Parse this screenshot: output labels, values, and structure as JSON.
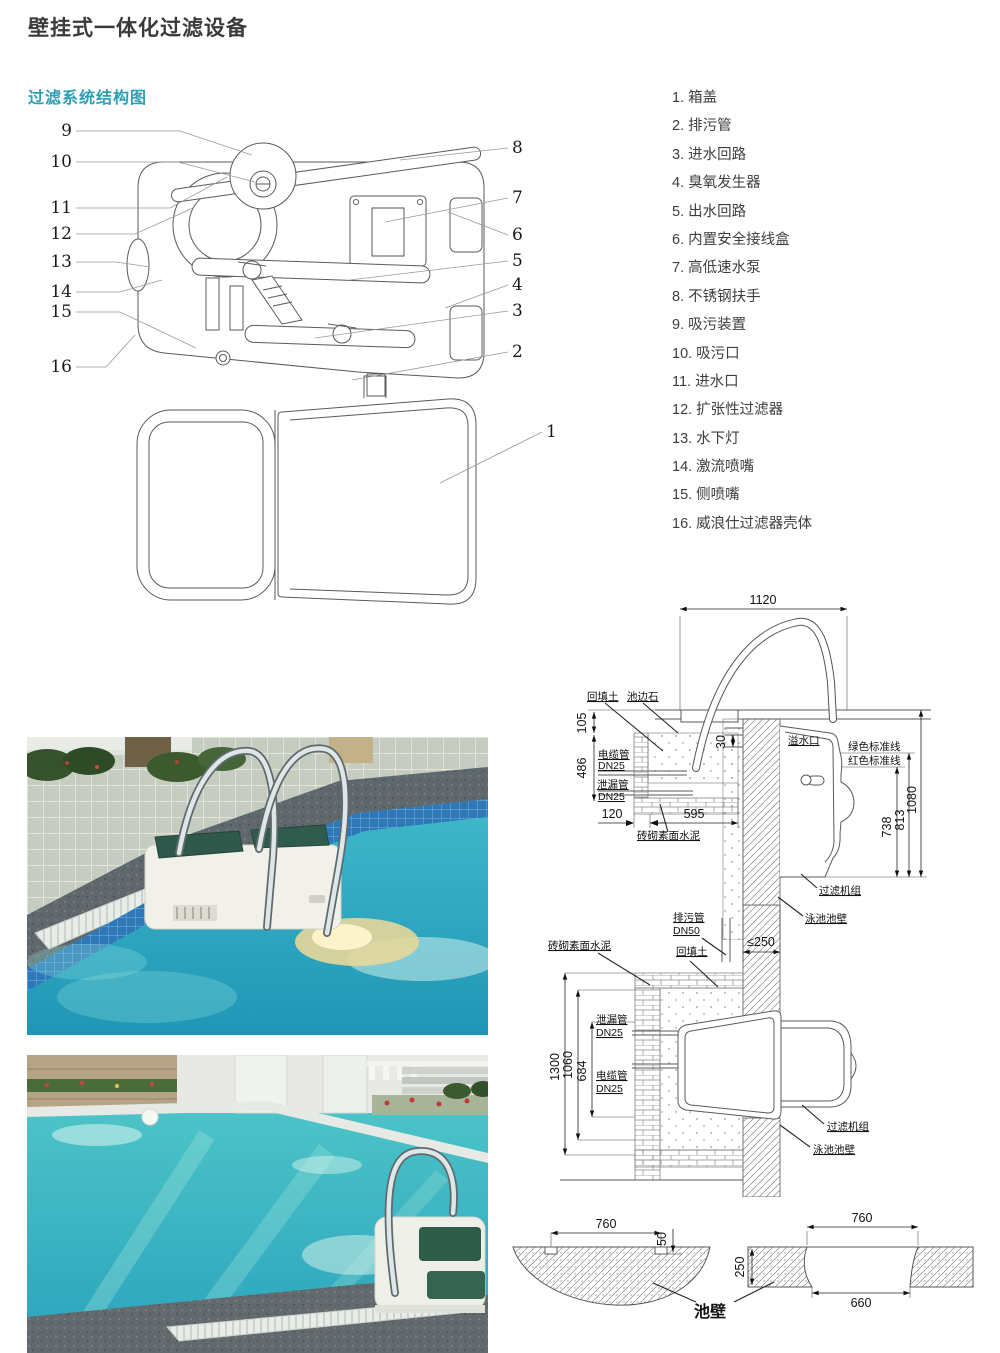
{
  "page": {
    "title": "壁挂式一体化过滤设备",
    "subtitle": "过滤系统结构图"
  },
  "colors": {
    "accent_teal": "#2e9eb3",
    "line": "#5a5a5a"
  },
  "legend": {
    "items": [
      "1. 箱盖",
      "2. 排污管",
      "3. 进水回路",
      "4. 臭氧发生器",
      "5. 出水回路",
      "6. 内置安全接线盒",
      "7. 高低速水泵",
      "8. 不锈钢扶手",
      "9. 吸污装置",
      "10. 吸污口",
      "11. 进水口",
      "12. 扩张性过滤器",
      "13. 水下灯",
      "14. 激流喷嘴",
      "15. 侧喷嘴",
      "16. 威浪仕过滤器壳体"
    ]
  },
  "structure": {
    "left": [
      "9",
      "10",
      "11",
      "12",
      "13",
      "14",
      "15",
      "16"
    ],
    "right": [
      "8",
      "7",
      "6",
      "5",
      "4",
      "3",
      "2"
    ],
    "lid": "1"
  },
  "sec1": {
    "d1120": "1120",
    "d105": "105",
    "d486": "486",
    "d30": "30",
    "d120": "120",
    "d595": "595",
    "d738": "738",
    "d813": "813",
    "d1080": "1080",
    "backfill": "回填土",
    "edgestone": "池边石",
    "cable1": "电缆管",
    "cable2": "DN25",
    "leak1": "泄漏管",
    "leak2": "DN25",
    "overflow": "溢水口",
    "greenline": "绿色标准线",
    "redline": "红色标准线",
    "masonry": "砖砌素面水泥",
    "unit": "过滤机组",
    "wall": "泳池池壁",
    "drain1": "排污管",
    "drain2": "DN50"
  },
  "sec2": {
    "d250": "≤250",
    "d1300": "1300",
    "d1060": "1060",
    "d684": "684",
    "masonry": "砖砌素面水泥",
    "backfill": "回填土",
    "leak1": "泄漏管",
    "leak2": "DN25",
    "cable1": "电缆管",
    "cable2": "DN25",
    "unit": "过滤机组",
    "wall": "泳池池壁"
  },
  "sec3": {
    "d760l": "760",
    "d50": "50",
    "d250": "250",
    "d760r": "760",
    "d660": "660",
    "wall": "池壁"
  }
}
